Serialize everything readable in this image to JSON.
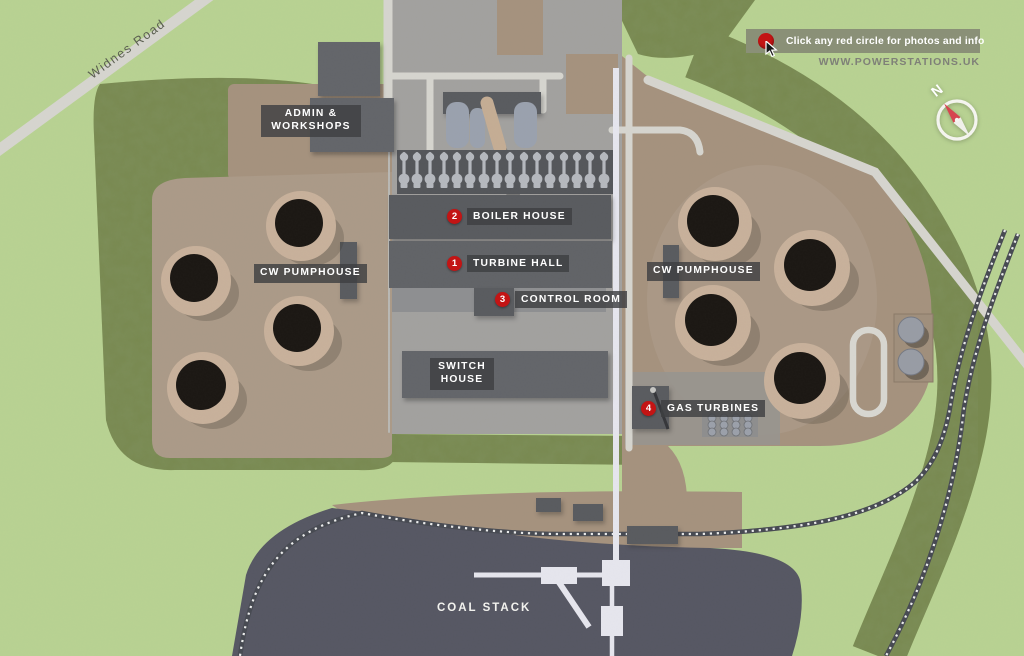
{
  "banner": {
    "instruction": "Click any red circle for photos and info"
  },
  "website": {
    "url_text": "WWW.POWERSTATIONS.UK"
  },
  "roads": {
    "widnes_road_label": "Widnes Road"
  },
  "compass": {
    "north_label": "N"
  },
  "markers": [
    {
      "number": "1",
      "label": "TURBINE HALL"
    },
    {
      "number": "2",
      "label": "BOILER HOUSE"
    },
    {
      "number": "3",
      "label": "CONTROL ROOM"
    },
    {
      "number": "4",
      "label": "GAS TURBINES"
    }
  ],
  "building_labels": {
    "admin_line1": "ADMIN &",
    "admin_line2": "WORKSHOPS",
    "cw_pumphouse_left": "CW PUMPHOUSE",
    "cw_pumphouse_right": "CW PUMPHOUSE",
    "switch_line1": "SWITCH",
    "switch_line2": "HOUSE",
    "coal_stack": "COAL STACK"
  },
  "colors": {
    "grass": "#b8d292",
    "trees": "#78894f",
    "road": "#d6d5cf",
    "slab": "#a2a19f",
    "ground": "#a5927e",
    "ground_right": "#ab9a88",
    "coal": "#565763",
    "rail": "#474a52",
    "conveyor": "#e6e6ee",
    "building": "#63656a",
    "building_dark": "#595b5f",
    "tower_rim": "#c8b19b",
    "tower_core": "#1b1713",
    "marker_red": "#c31414",
    "label_bg": "rgba(62,63,66,0.82)",
    "banner_bg": "#8a9077",
    "website_text": "#7f8078",
    "text_dark": "#5a5e50"
  }
}
